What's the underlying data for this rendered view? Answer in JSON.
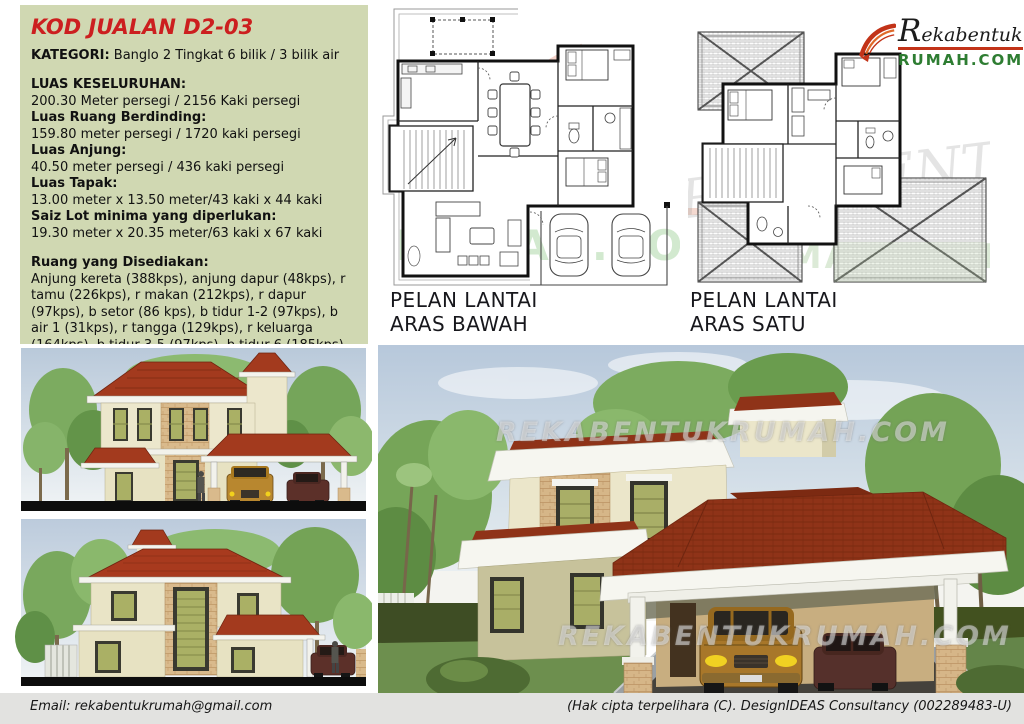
{
  "info": {
    "title": "KOD JUALAN D2-03",
    "category_label": "KATEGORI:",
    "category_value": "Banglo 2 Tingkat 6 bilik / 3 bilik air",
    "specs": [
      {
        "label": "LUAS KESELURUHAN:",
        "value": "200.30 Meter persegi / 2156 Kaki persegi"
      },
      {
        "label": "Luas Ruang Berdinding:",
        "value": "159.80 meter persegi / 1720 kaki persegi"
      },
      {
        "label": "Luas Anjung:",
        "value": "40.50 meter persegi / 436 kaki persegi"
      },
      {
        "label": "Luas Tapak:",
        "value": "13.00 meter x 13.50 meter/43 kaki x 44 kaki"
      },
      {
        "label": "Saiz Lot minima yang diperlukan:",
        "value": "19.30 meter x 20.35 meter/63 kaki x 67 kaki"
      }
    ],
    "rooms_label": "Ruang yang Disediakan:",
    "rooms_text": "Anjung kereta (388kps), anjung dapur (48kps), r tamu (226kps), r makan (212kps), r dapur (97kps), b setor (86 kps), b tidur 1-2 (97kps), b air 1 (31kps), r tangga (129kps), r keluarga (164kps), b tidur 3-5 (97kps), b tidur 6 (185kps), b air 2 (31kps) & b air 3 (32kps)"
  },
  "plans": {
    "ground": {
      "line1": "PELAN LANTAI",
      "line2": "ARAS BAWAH"
    },
    "first": {
      "line1": "PELAN LANTAI",
      "line2": "ARAS SATU"
    }
  },
  "logo": {
    "name_script": "Rekabentuk",
    "name_domain": "RUMAH.COM"
  },
  "watermark": {
    "site": "REKABENTUKRUMAH.COM",
    "script": "REKABENTUK",
    "rumah": "RUMAH.COM",
    "initial": "R"
  },
  "footer": {
    "email": "Email: rekabentukrumah@gmail.com",
    "copyright": "(Hak cipta terpelihara (C). DesignIDEAS Consultancy (002289483-U)"
  },
  "colors": {
    "accent_red": "#cc1f1f",
    "panel_green": "#d0d8b2",
    "logo_green": "#2e7d32",
    "roof_red": "#9a3520",
    "footer_gray": "#e2e2e0"
  }
}
